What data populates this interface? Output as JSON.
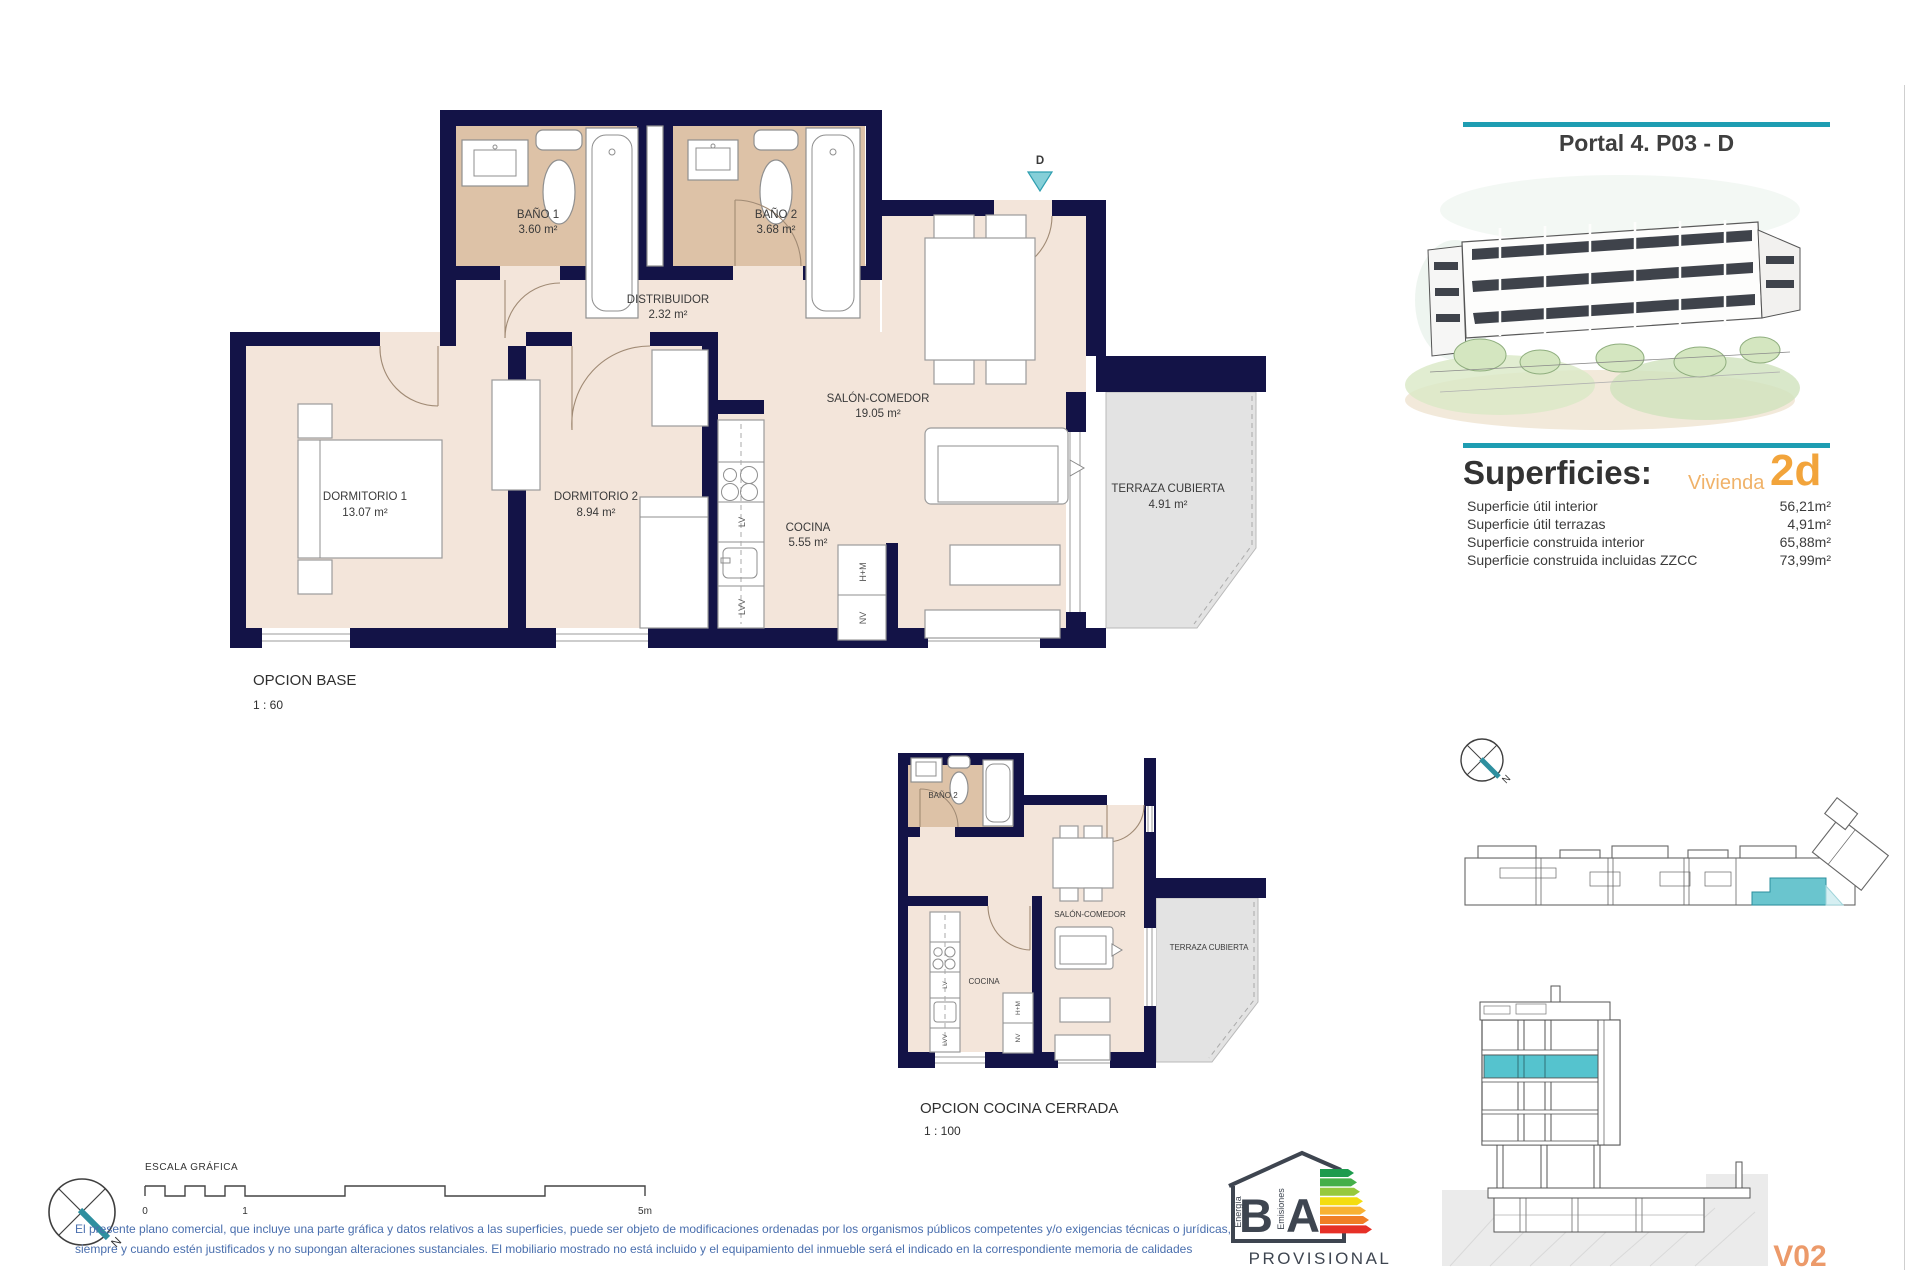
{
  "colors": {
    "teal_accent": "#1e9db2",
    "orange_accent": "#f2a43b",
    "wall_navy": "#131347",
    "floor_beige": "#f3e5da",
    "bath_tan": "#ddc2a7",
    "terrace_grey": "#e3e3e3",
    "highlight_teal": "#55c3ce",
    "disclaimer_blue": "#4a6fae",
    "sheet_code_orange": "#ec9a6a"
  },
  "header": {
    "title": "Portal 4. P03 - D"
  },
  "superficies": {
    "heading": "Superficies:",
    "vivienda_label": "Vivienda",
    "vivienda_code": "2d",
    "rows": [
      {
        "label": "Superficie útil interior",
        "value": "56,21m²"
      },
      {
        "label": "Superficie útil terrazas",
        "value": "4,91m²"
      },
      {
        "label": "Superficie construida interior",
        "value": "65,88m²"
      },
      {
        "label": "Superficie construida incluidas ZZCC",
        "value": "73,99m²"
      }
    ]
  },
  "plan_base": {
    "title": "OPCION BASE",
    "scale": "1 : 60",
    "entry_label": "D",
    "rooms": [
      {
        "name": "BAÑO 1",
        "area": "3.60 m²"
      },
      {
        "name": "BAÑO 2",
        "area": "3.68 m²"
      },
      {
        "name": "DISTRIBUIDOR",
        "area": "2.32 m²"
      },
      {
        "name": "SALÓN-COMEDOR",
        "area": "19.05 m²"
      },
      {
        "name": "DORMITORIO 1",
        "area": "13.07 m²"
      },
      {
        "name": "DORMITORIO 2",
        "area": "8.94 m²"
      },
      {
        "name": "COCINA",
        "area": "5.55 m²"
      },
      {
        "name": "TERRAZA CUBIERTA",
        "area": "4.91 m²"
      }
    ]
  },
  "plan_cerrada": {
    "title": "OPCION COCINA CERRADA",
    "scale": "1 : 100",
    "rooms": [
      {
        "name": "BAÑO 2"
      },
      {
        "name": "SALÓN-COMEDOR"
      },
      {
        "name": "COCINA"
      },
      {
        "name": "TERRAZA CUBIERTA"
      }
    ]
  },
  "appliances": {
    "lv": "LV",
    "lvv": "LVV",
    "hm": "H+M",
    "nv": "NV"
  },
  "compass": {
    "north": "N"
  },
  "scale_bar": {
    "label": "ESCALA GRÁFICA",
    "tick0": "0",
    "tick1": "1",
    "tick5": "5m"
  },
  "disclaimer": {
    "line1": "El presente plano comercial, que incluye una parte gráfica y datos relativos a las superficies, puede ser objeto de modificaciones ordenadas por los organismos públicos competentes y/o exigencias técnicas o jurídicas,",
    "line2": "siempre y cuando estén justificados y no supongan alteraciones sustanciales. El mobiliario mostrado no está incluido y el equipamiento del inmueble será el indicado en la correspondiente memoria de calidades"
  },
  "energy_logo": {
    "letter_b": "B",
    "letter_a": "A",
    "left_label": "Energía",
    "right_label": "Emisiones",
    "status": "PROVISIONAL"
  },
  "sheet_code": "V02"
}
